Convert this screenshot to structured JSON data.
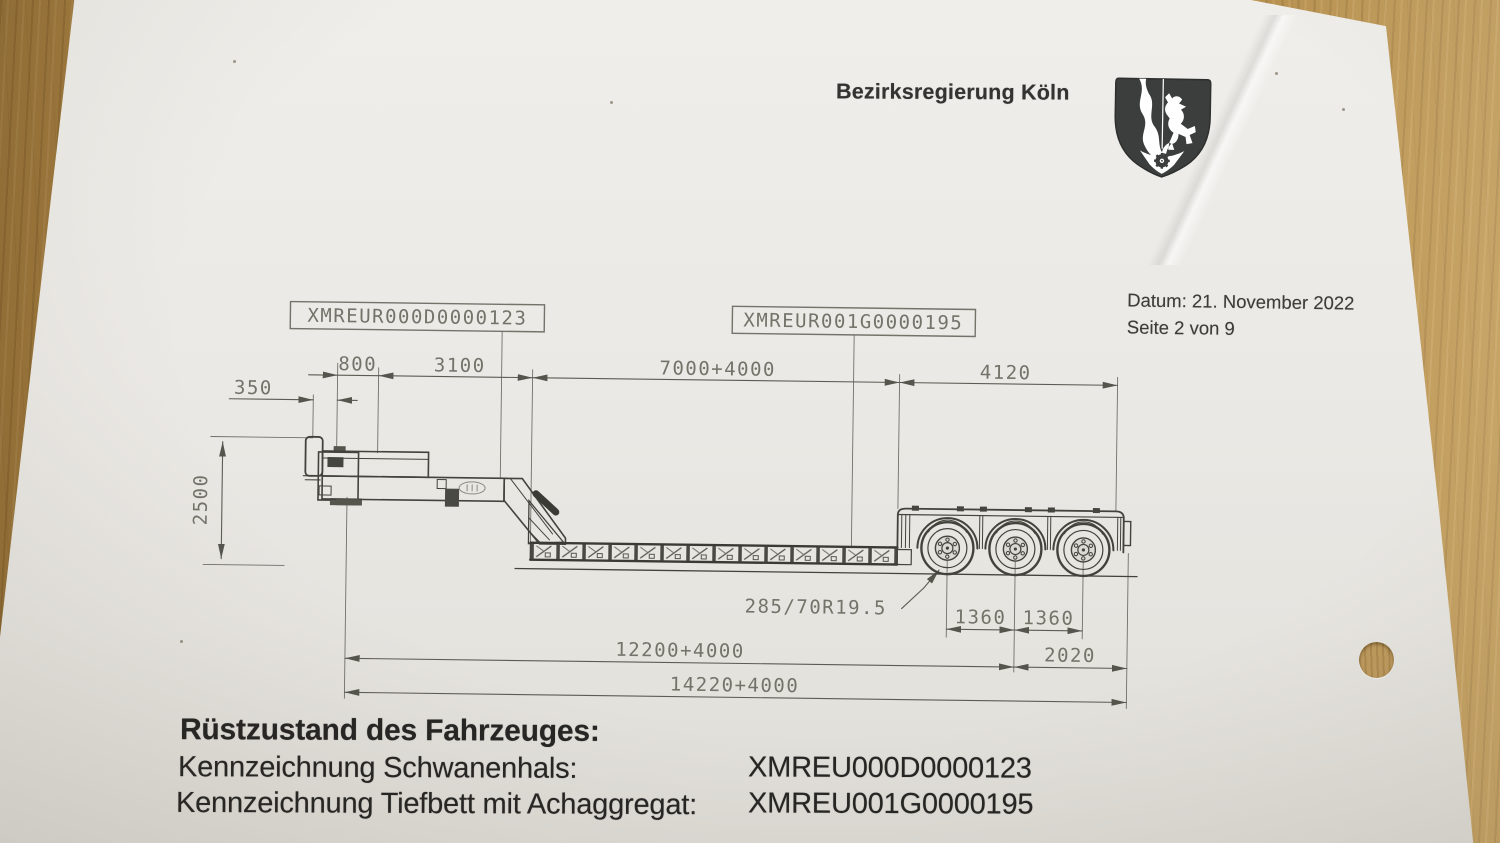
{
  "colors": {
    "wood": "#b28a47",
    "paper": "#ebe9e5",
    "ink_text": "#262624",
    "cad_line": "#55554e",
    "cad_text": "#73736a",
    "emblem": "#3c3e3d"
  },
  "header": {
    "agency": "Bezirksregierung Köln"
  },
  "meta": {
    "date": "Datum: 21. November 2022",
    "page": "Seite 2 von 9"
  },
  "drawing": {
    "vin_boxes": {
      "gooseneck": "XMREUR000D0000123",
      "lowbed": "XMREUR001G0000195"
    },
    "dims": {
      "front_overhang": "350",
      "kingpin": "800",
      "neck_length": "3100",
      "bed_length": "7000+4000",
      "rear_length": "4120",
      "height": "2500",
      "tire_size": "285/70R19.5",
      "axle_gap_1": "1360",
      "axle_gap_2": "1360",
      "kingpin_to_axles": "12200+4000",
      "rear_overhang": "2020",
      "total_length": "14220+4000"
    }
  },
  "footer": {
    "title": "Rüstzustand des Fahrzeuges:",
    "rows": [
      {
        "label": "Kennzeichnung Schwanenhals:",
        "value": "XMREU000D0000123"
      },
      {
        "label": "Kennzeichnung Tiefbett mit Achaggregat:",
        "value": "XMREU001G0000195"
      }
    ]
  }
}
